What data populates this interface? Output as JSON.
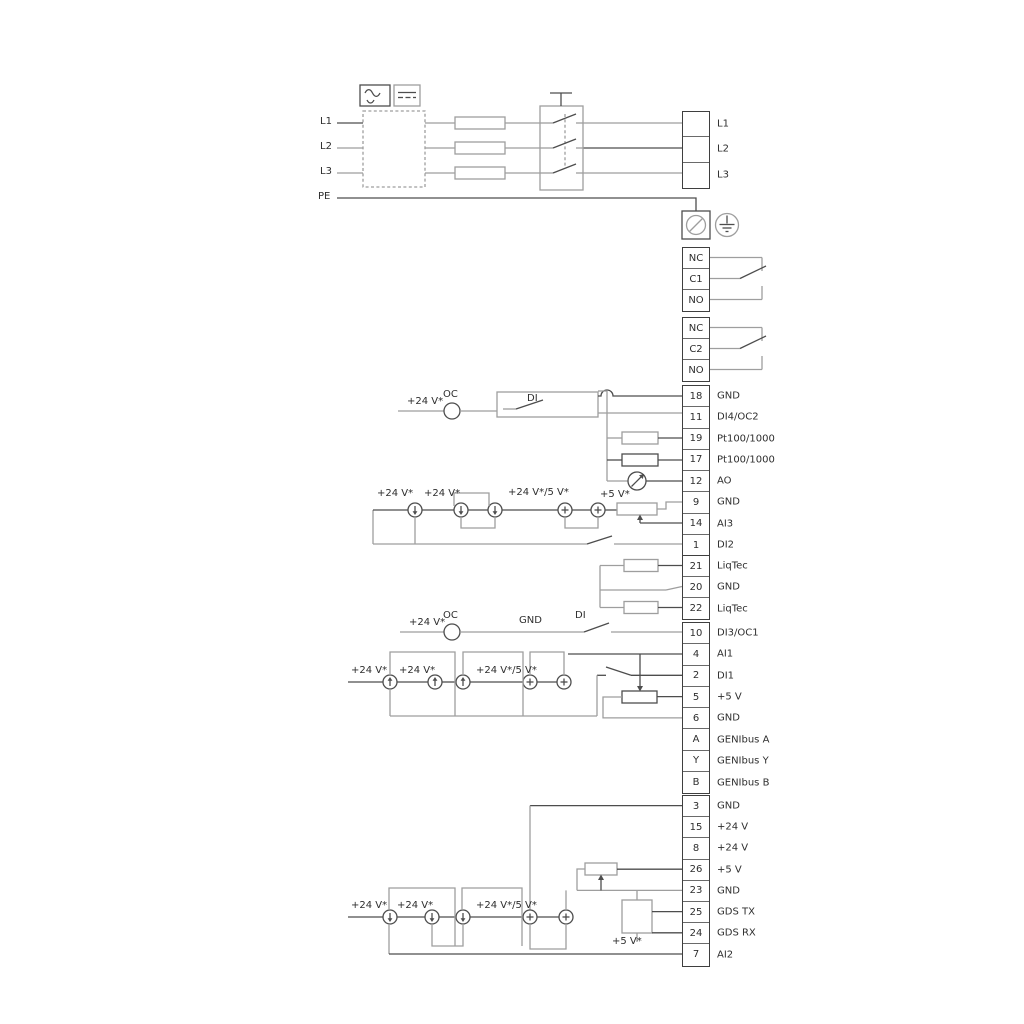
{
  "power_inputs": {
    "l1": "L1",
    "l2": "L2",
    "l3": "L3",
    "pe": "PE"
  },
  "blocks": [
    {
      "id": "power-output",
      "cells": [
        {
          "num": "",
          "label": "L1"
        },
        {
          "num": "",
          "label": "L2"
        },
        {
          "num": "",
          "label": "L3"
        }
      ]
    },
    {
      "id": "relay-1",
      "cells": [
        {
          "num": "NC",
          "label": ""
        },
        {
          "num": "C1",
          "label": ""
        },
        {
          "num": "NO",
          "label": ""
        }
      ]
    },
    {
      "id": "relay-2",
      "cells": [
        {
          "num": "NC",
          "label": ""
        },
        {
          "num": "C2",
          "label": ""
        },
        {
          "num": "NO",
          "label": ""
        }
      ]
    },
    {
      "id": "io-top",
      "cells": [
        {
          "num": "18",
          "label": "GND"
        },
        {
          "num": "11",
          "label": "DI4/OC2"
        },
        {
          "num": "19",
          "label": "Pt100/1000"
        },
        {
          "num": "17",
          "label": "Pt100/1000"
        },
        {
          "num": "12",
          "label": "AO"
        },
        {
          "num": "9",
          "label": "GND"
        },
        {
          "num": "14",
          "label": "AI3"
        },
        {
          "num": "1",
          "label": "DI2"
        }
      ]
    },
    {
      "id": "liqtec",
      "cells": [
        {
          "num": "21",
          "label": "LiqTec"
        },
        {
          "num": "20",
          "label": "GND"
        },
        {
          "num": "22",
          "label": "LiqTec"
        }
      ]
    },
    {
      "id": "io-mid",
      "cells": [
        {
          "num": "10",
          "label": "DI3/OC1"
        },
        {
          "num": "4",
          "label": "AI1"
        },
        {
          "num": "2",
          "label": "DI1"
        },
        {
          "num": "5",
          "label": "+5 V"
        },
        {
          "num": "6",
          "label": "GND"
        },
        {
          "num": "A",
          "label": "GENIbus A"
        },
        {
          "num": "Y",
          "label": "GENIbus Y"
        },
        {
          "num": "B",
          "label": "GENIbus B"
        }
      ]
    },
    {
      "id": "io-bottom",
      "cells": [
        {
          "num": "3",
          "label": "GND"
        },
        {
          "num": "15",
          "label": "+24 V"
        },
        {
          "num": "8",
          "label": "+24 V"
        },
        {
          "num": "26",
          "label": "+5 V"
        },
        {
          "num": "23",
          "label": "GND"
        },
        {
          "num": "25",
          "label": "GDS TX"
        },
        {
          "num": "24",
          "label": "GDS RX"
        },
        {
          "num": "7",
          "label": "AI2"
        }
      ]
    }
  ],
  "annotations": {
    "a_v24": "+24 V*",
    "a_oc": "OC",
    "a_di": "DI",
    "b_v24a": "+24 V*",
    "b_v24b": "+24 V*",
    "b_v245": "+24 V*/5 V*",
    "b_v5": "+5 V*",
    "d_v24": "+24 V*",
    "d_oc": "OC",
    "d_gnd": "GND",
    "d_di": "DI",
    "e_v24a": "+24 V*",
    "e_v24b": "+24 V*",
    "e_v245": "+24 V*/5 V*",
    "f_v24a": "+24 V*",
    "f_v24b": "+24 V*",
    "f_v245": "+24 V*/5 V*",
    "f_v5": "+5 V*"
  },
  "icons": {
    "ac-symbol": "sine-wave",
    "dc-symbol": "line-over-dashes",
    "earth-terminal": "circle-with-slash",
    "protective-earth": "ground-in-circle",
    "current-source": "circle-with-arrow",
    "voltage-source": "circle-with-plus",
    "analog-meter": "circle-with-diagonal-arrow",
    "potentiometer": "resistor-with-wiper-arrow",
    "resistor": "rectangle",
    "switch-contact": "blade",
    "gds-sensor": "square-box"
  },
  "colors": {
    "background": "#ffffff",
    "wire_gray": "#9e9e9e",
    "wire_dark": "#4d4d4d",
    "text": "#2e2e2e",
    "terminal_border": "#3f3f3f"
  }
}
